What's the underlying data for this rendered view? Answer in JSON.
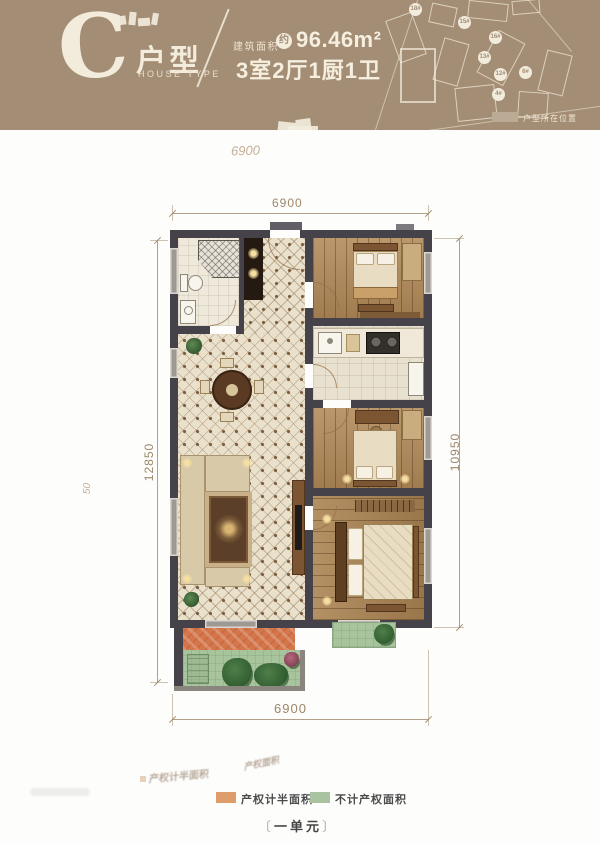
{
  "header": {
    "type_letter": "C",
    "type_label": "户型",
    "type_label_en": "HOUSE TYPE",
    "area_label": "建筑面积",
    "area_circle": "约",
    "area_value": "96.46m²",
    "rooms_summary": "3室2厅1厨1卫",
    "colors": {
      "header_bg": "#a38d74",
      "cream": "#f3ecdc"
    },
    "siteplan": {
      "legend_label": "户型所在位置",
      "badges": [
        {
          "label": "18#"
        },
        {
          "label": "15#"
        },
        {
          "label": "16#"
        },
        {
          "label": "13#"
        },
        {
          "label": "12#"
        },
        {
          "label": "6#"
        },
        {
          "label": "4#"
        }
      ]
    }
  },
  "plan": {
    "dim_top": "6900",
    "dim_bottom": "6900",
    "dim_left": "12850",
    "dim_right": "10950",
    "ghost_dim": "6900",
    "ghost_side": "50"
  },
  "legend": {
    "items": [
      {
        "label": "产权计半面积",
        "color": "#dd9e6b"
      },
      {
        "label": "不计产权面积",
        "color": "#a9c3a0"
      }
    ],
    "unit_label": "一单元",
    "bracket_left": "〔",
    "bracket_right": "〕",
    "ghost_text_1": "产权计半面积",
    "ghost_text_2": "产权面积"
  }
}
